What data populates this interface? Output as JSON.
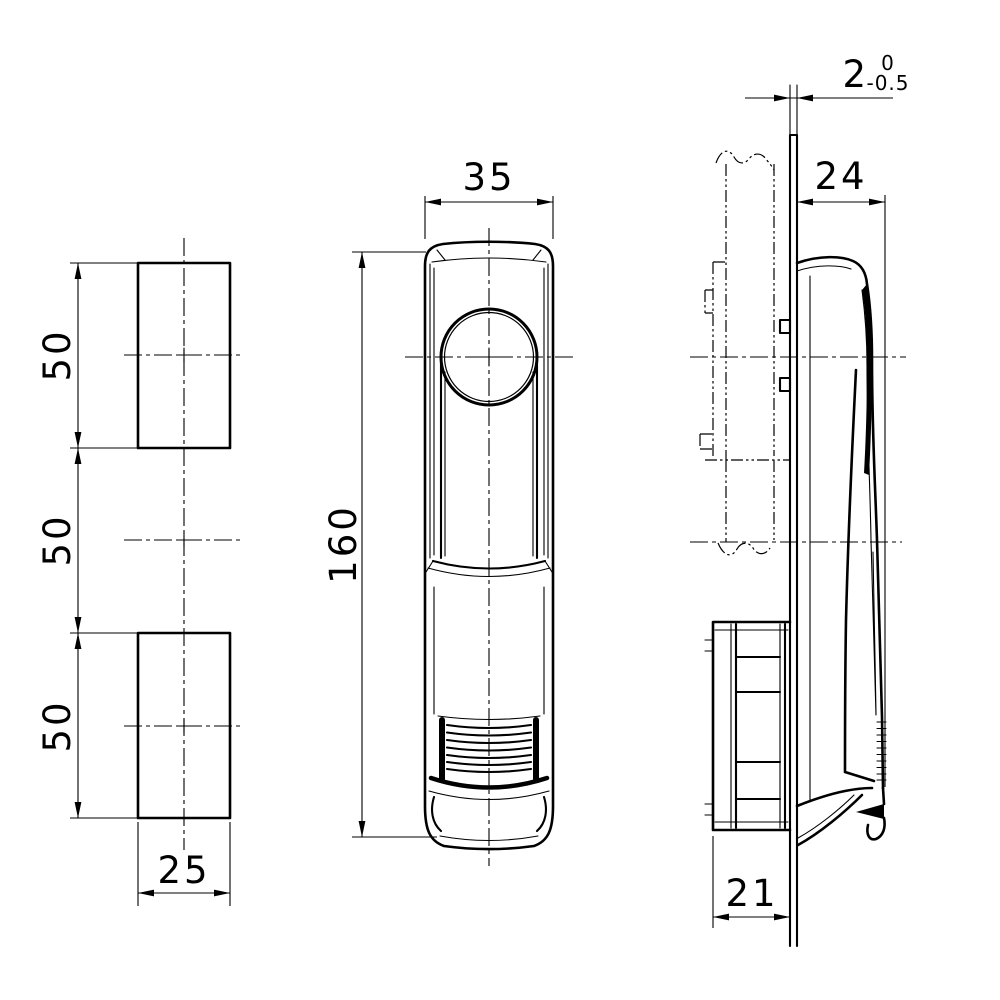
{
  "colors": {
    "line": "#000000",
    "background": "#ffffff"
  },
  "dims": {
    "cut_top": "50",
    "cut_mid": "50",
    "cut_bottom": "50",
    "cut_width": "25",
    "handle_width": "35",
    "handle_height": "160",
    "panel_thickness": "2",
    "panel_tol_upper": "0",
    "panel_tol_lower": "-0.5",
    "side_protrusion": "24",
    "side_depth": "21"
  }
}
